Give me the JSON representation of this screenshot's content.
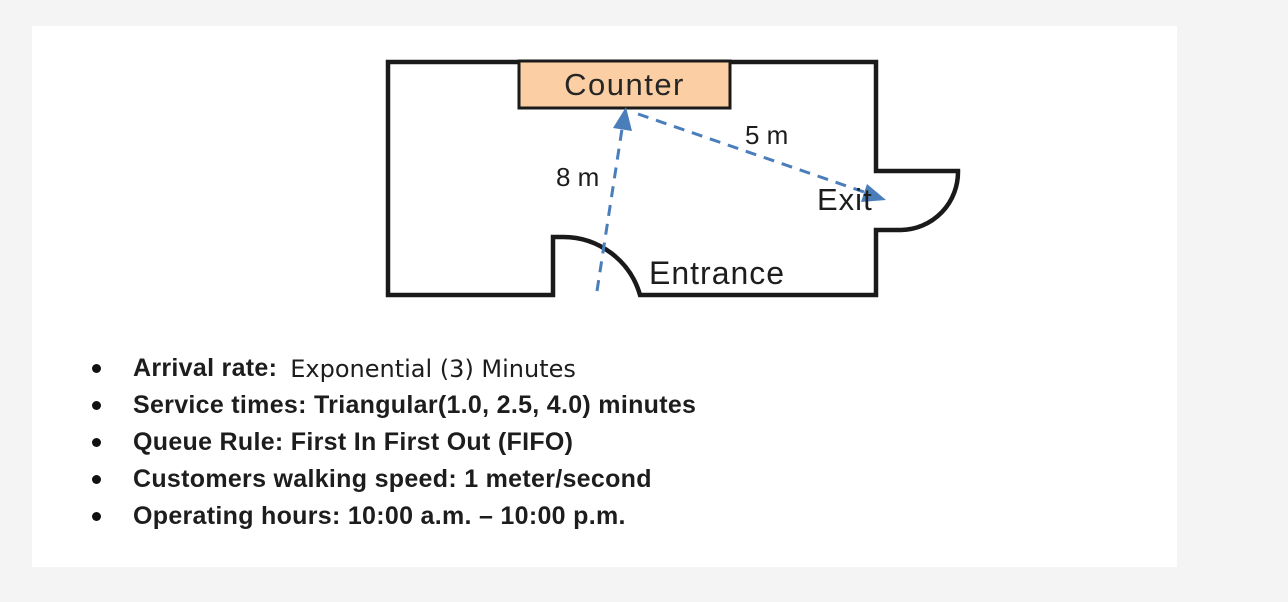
{
  "diagram": {
    "counter_label": "Counter",
    "entrance_label": "Entrance",
    "exit_label": "Exit",
    "distance_entrance_to_counter": "8 m",
    "distance_counter_to_exit": "5 m",
    "colors": {
      "wall": "#1a1a1a",
      "counter_fill": "#fbcfa3",
      "path_arrow_blue": "#4a7ebb",
      "canvas_background": "#ffffff",
      "page_background": "#f3f4f3"
    }
  },
  "specs": {
    "arrival": {
      "label": "Arrival rate:",
      "value": "Exponential (3) Minutes"
    },
    "service": "Service times: Triangular(1.0, 2.5, 4.0) minutes",
    "queue": "Queue Rule: First In First Out (FIFO)",
    "walking": "Customers walking speed: 1 meter/second",
    "hours": "Operating hours: 10:00 a.m. – 10:00 p.m."
  }
}
